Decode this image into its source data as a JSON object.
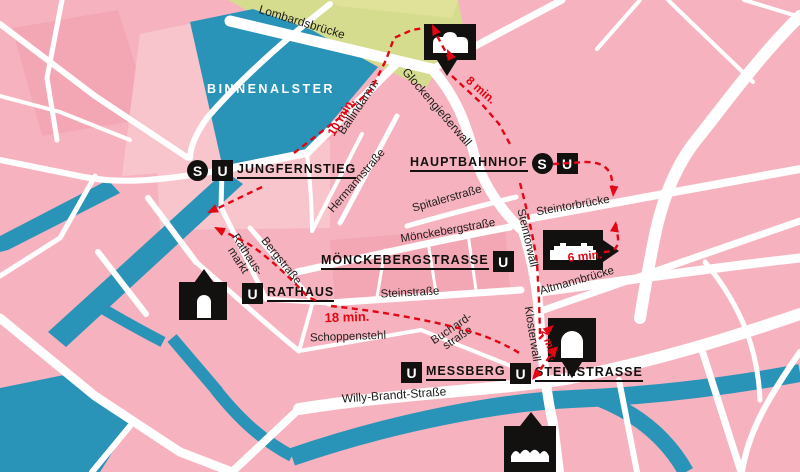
{
  "map": {
    "water_label": "BINNENALSTER",
    "streets": {
      "lombardsbruecke": "Lombardsbrücke",
      "glockengiesserwall": "Glockengießerwall",
      "ballindamm": "Ballindamm",
      "hermannstrasse": "Hermannstraße",
      "spitalerstrasse": "Spitalerstraße",
      "steintorbruecke": "Steintorbrücke",
      "moenckebergstrasse": "Mönckebergstraße",
      "steintorwall": "Steintorwall",
      "klosterwall": "Klosterwall",
      "altmannbruecke": "Altmannbrücke",
      "bergstrasse": "Bergstraße",
      "rathausmarkt_line1": "Rathaus-",
      "rathausmarkt_line2": "markt",
      "steinstrasse": "Steinstraße",
      "schoppenstehl": "Schoppenstehl",
      "buchardstrasse_line1": "Buchard-",
      "buchardstrasse_line2": "straße",
      "willy_brandt_strasse": "Willy-Brandt-Straße"
    },
    "stations": {
      "jungfernstieg": "JUNGFERNSTIEG",
      "hauptbahnhof": "HAUPTBAHNHOF",
      "moenckebergstrasse": "MÖNCKEBERGSTRASSE",
      "rathaus": "RATHAUS",
      "messberg": "MESSBERG",
      "steinstrasse": "STEINSTRASSE"
    },
    "badges": {
      "s": "S",
      "u": "U"
    },
    "walk_times": {
      "ten": "10 min.",
      "eight": "8 min.",
      "eighteen": "18 min.",
      "six": "6 min.",
      "two": "2 min."
    },
    "colors": {
      "city_pink": "#f6b3bf",
      "water_blue": "#2a93b8",
      "park_green": "#d6dc8e",
      "street_white": "#ffffff",
      "route_red": "#e30613",
      "marker_black": "#13110f"
    }
  }
}
